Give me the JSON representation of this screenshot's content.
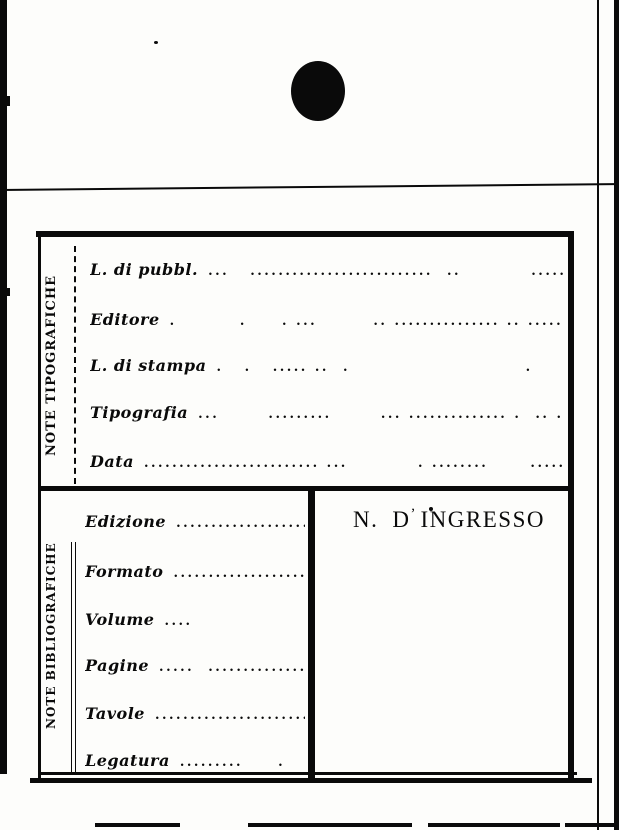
{
  "palette": {
    "ink": "#0a0a0a",
    "paper": "#fdfdfb"
  },
  "sections": {
    "tipografiche": {
      "title": "NOTE TIPOGRAFICHE",
      "fields": [
        {
          "label": "L. di pubbl.",
          "leader": "...   ..........................  ..          ......"
        },
        {
          "label": "Editore",
          "leader": ".         .     . ...        .. ............... .. ......"
        },
        {
          "label": "L. di stampa",
          "leader": ".   .   ..... ..  .                         ."
        },
        {
          "label": "Tipografia",
          "leader": "...       .........       ... .............. .  .. ....."
        },
        {
          "label": "Data",
          "leader": "......................... ...          . ........      ........."
        }
      ]
    },
    "bibliografiche": {
      "title": "NOTE BIBLIOGRAFICHE",
      "fields": [
        {
          "label": "Edizione",
          "leader": "...................."
        },
        {
          "label": "Formato",
          "leader": "....................."
        },
        {
          "label": "Volume",
          "leader": "....                 ."
        },
        {
          "label": "Pagine",
          "leader": ".....  .............."
        },
        {
          "label": "Tavole",
          "leader": "......................."
        },
        {
          "label": "Legatura",
          "leader": ".........     .   ..."
        }
      ]
    }
  },
  "ingresso": {
    "n": "N.",
    "d": "D",
    "apostrophe": "’",
    "word": "INGRESSO"
  }
}
